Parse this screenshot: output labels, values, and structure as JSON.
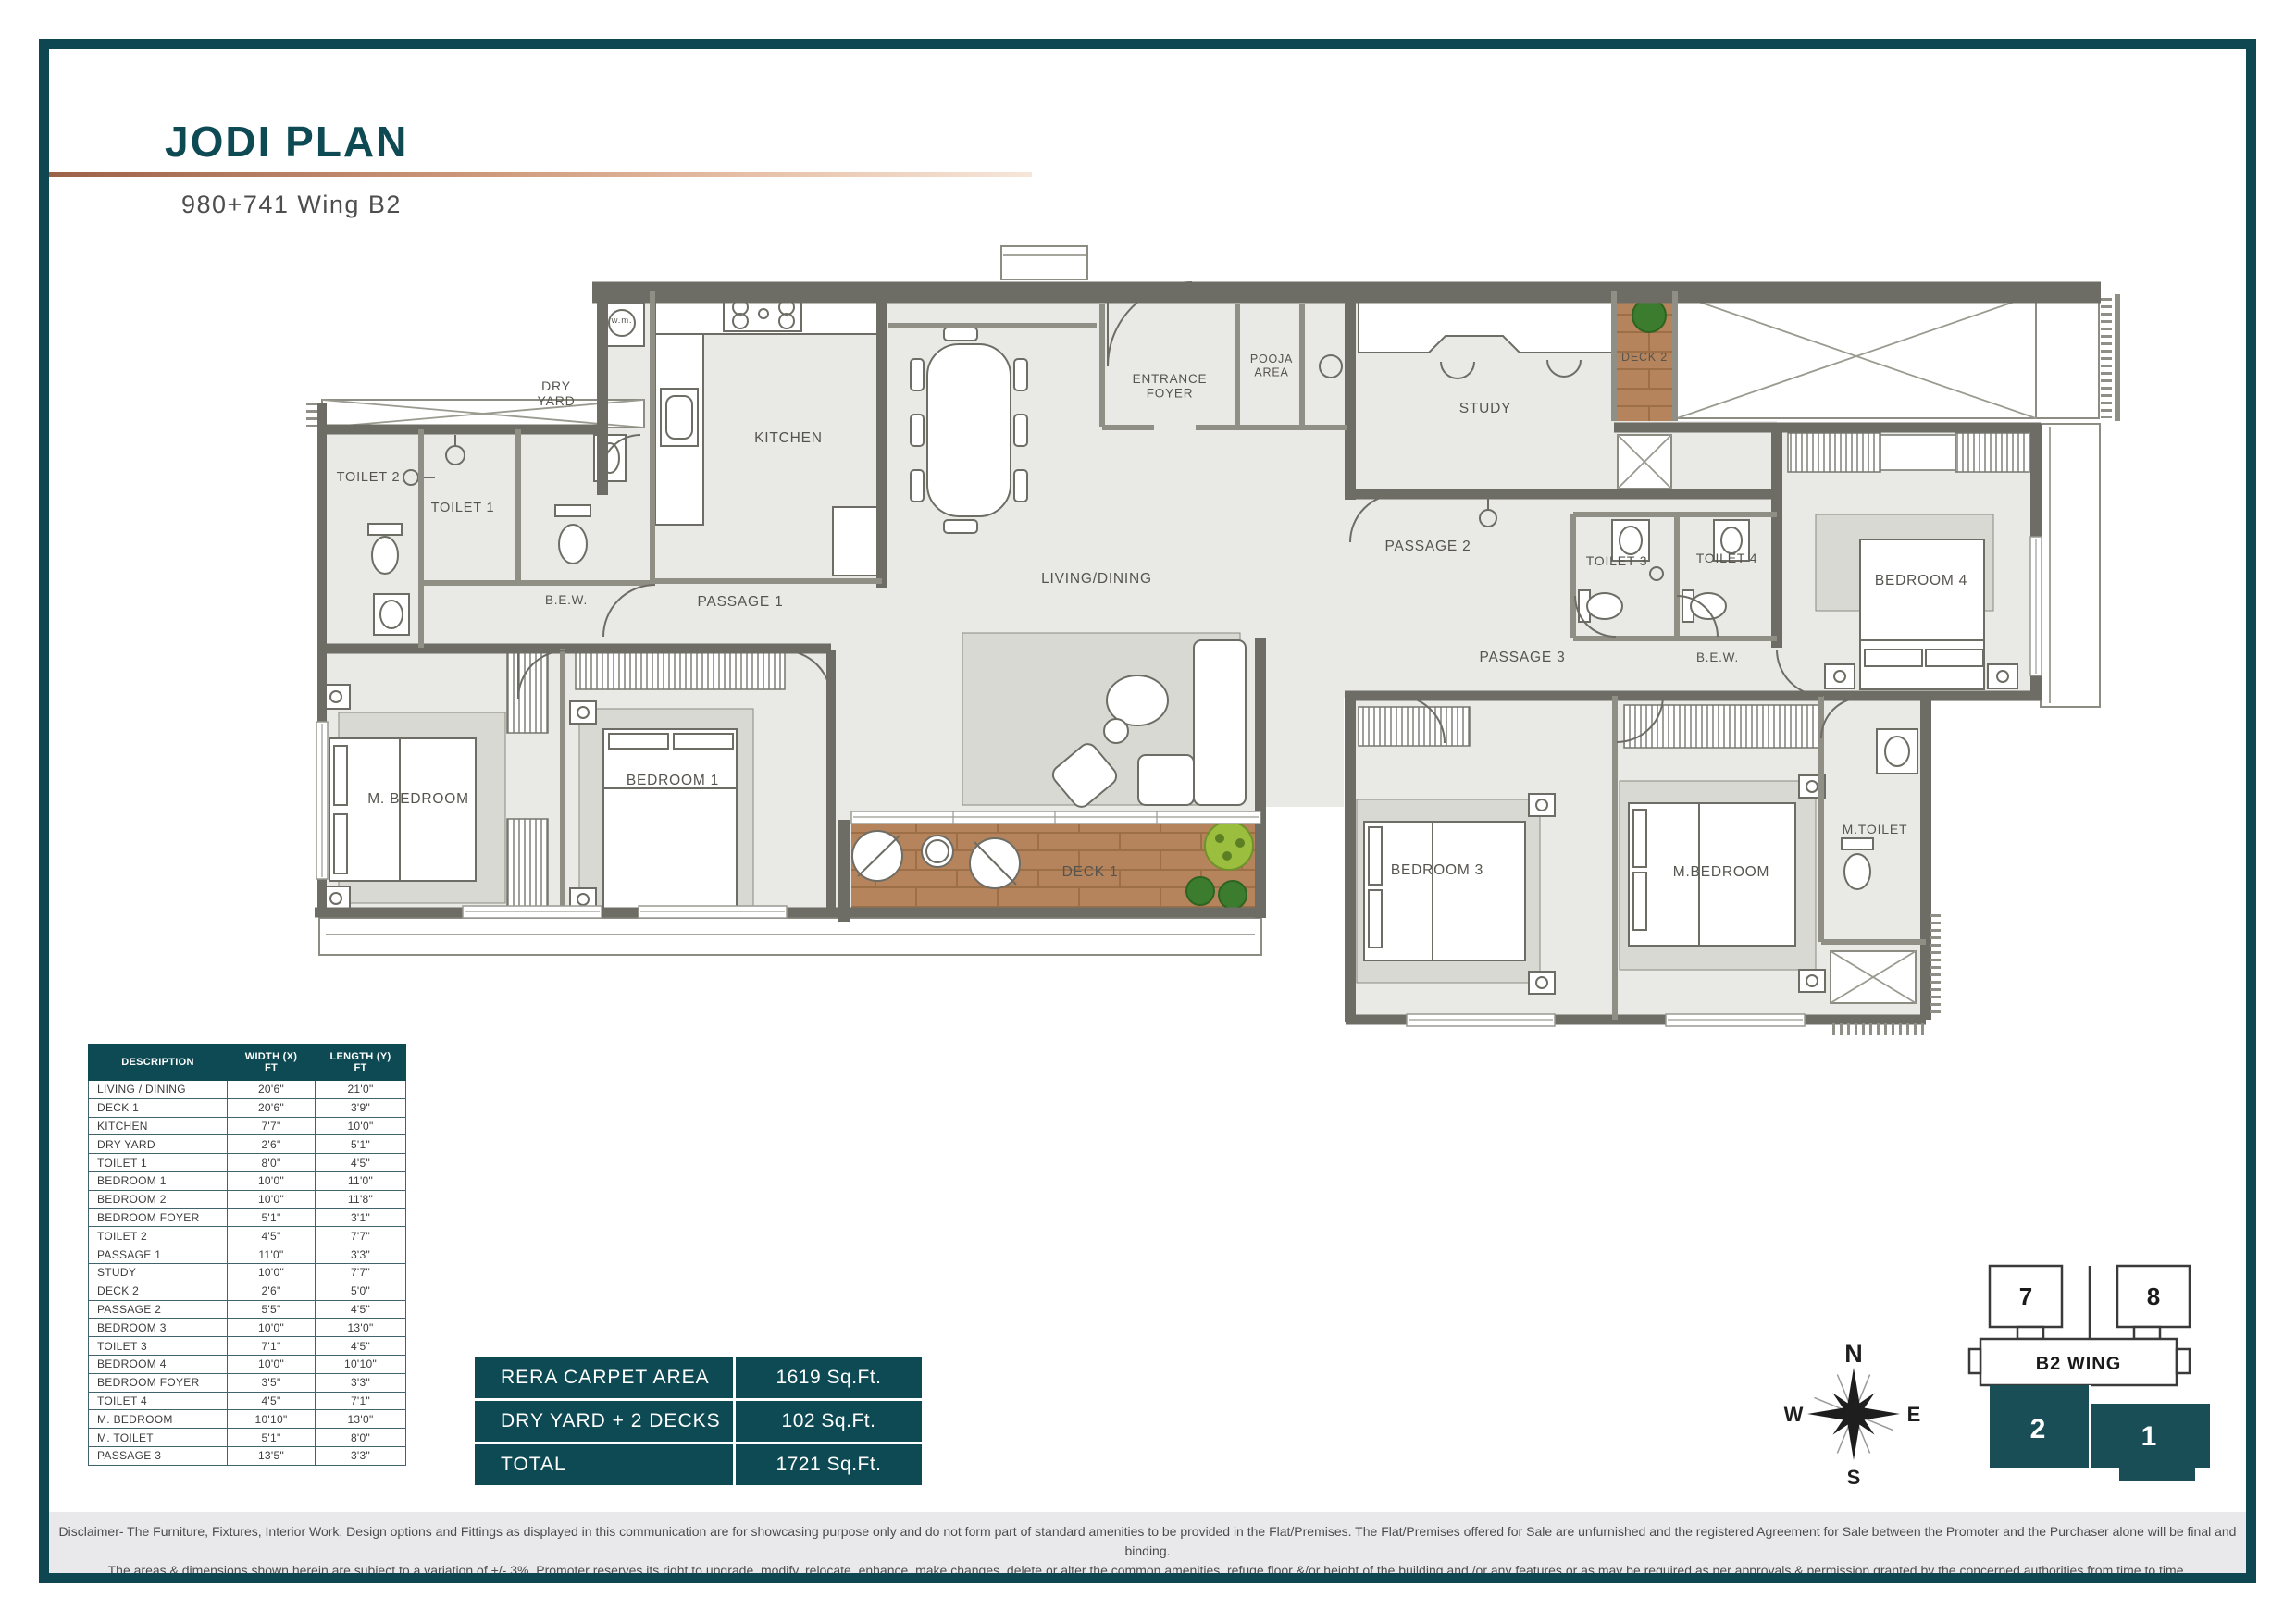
{
  "header": {
    "title": "JODI PLAN",
    "subtitle": "980+741 Wing B2"
  },
  "dimensions_table": {
    "headers": [
      "DESCRIPTION",
      "WIDTH (X)\nFT",
      "LENGTH (Y)\nFT"
    ],
    "rows": [
      [
        "LIVING / DINING",
        "20'6\"",
        "21'0\""
      ],
      [
        "DECK 1",
        "20'6\"",
        "3'9\""
      ],
      [
        "KITCHEN",
        "7'7\"",
        "10'0\""
      ],
      [
        "DRY YARD",
        "2'6\"",
        "5'1\""
      ],
      [
        "TOILET 1",
        "8'0\"",
        "4'5\""
      ],
      [
        "BEDROOM 1",
        "10'0\"",
        "11'0\""
      ],
      [
        "BEDROOM 2",
        "10'0\"",
        "11'8\""
      ],
      [
        "BEDROOM FOYER",
        "5'1\"",
        "3'1\""
      ],
      [
        "TOILET 2",
        "4'5\"",
        "7'7\""
      ],
      [
        "PASSAGE 1",
        "11'0\"",
        "3'3\""
      ],
      [
        "STUDY",
        "10'0\"",
        "7'7\""
      ],
      [
        "DECK 2",
        "2'6\"",
        "5'0\""
      ],
      [
        "PASSAGE 2",
        "5'5\"",
        "4'5\""
      ],
      [
        "BEDROOM 3",
        "10'0\"",
        "13'0\""
      ],
      [
        "TOILET 3",
        "7'1\"",
        "4'5\""
      ],
      [
        "BEDROOM 4",
        "10'0\"",
        "10'10\""
      ],
      [
        "BEDROOM FOYER",
        "3'5\"",
        "3'3\""
      ],
      [
        "TOILET 4",
        "4'5\"",
        "7'1\""
      ],
      [
        "M. BEDROOM",
        "10'10\"",
        "13'0\""
      ],
      [
        "M. TOILET",
        "5'1\"",
        "8'0\""
      ],
      [
        "PASSAGE 3",
        "13'5\"",
        "3'3\""
      ]
    ]
  },
  "area_table": {
    "rows": [
      {
        "label": "RERA CARPET AREA",
        "value": "1619 Sq.Ft."
      },
      {
        "label": "DRY YARD + 2 DECKS",
        "value": "102 Sq.Ft."
      },
      {
        "label": "TOTAL",
        "value": "1721 Sq.Ft."
      }
    ]
  },
  "floorplan": {
    "rooms": [
      {
        "id": "toilet2",
        "label": "TOILET 2"
      },
      {
        "id": "toilet1",
        "label": "TOILET 1"
      },
      {
        "id": "dry_yard",
        "label": "DRY\nYARD"
      },
      {
        "id": "wm",
        "label": "w.m."
      },
      {
        "id": "kitchen",
        "label": "KITCHEN"
      },
      {
        "id": "bew1",
        "label": "B.E.W."
      },
      {
        "id": "passage1",
        "label": "PASSAGE 1"
      },
      {
        "id": "living_dining",
        "label": "LIVING/DINING"
      },
      {
        "id": "entrance_foyer",
        "label": "ENTRANCE\nFOYER"
      },
      {
        "id": "pooja_area",
        "label": "POOJA\nAREA"
      },
      {
        "id": "study",
        "label": "STUDY"
      },
      {
        "id": "passage2",
        "label": "PASSAGE 2"
      },
      {
        "id": "deck2",
        "label": "DECK 2"
      },
      {
        "id": "toilet3",
        "label": "TOILET 3"
      },
      {
        "id": "toilet4",
        "label": "TOILET 4"
      },
      {
        "id": "bedroom4",
        "label": "BEDROOM 4"
      },
      {
        "id": "passage3",
        "label": "PASSAGE 3"
      },
      {
        "id": "bew2",
        "label": "B.E.W."
      },
      {
        "id": "m_bedroom1",
        "label": "M. BEDROOM"
      },
      {
        "id": "bedroom1",
        "label": "BEDROOM 1"
      },
      {
        "id": "deck1",
        "label": "DECK 1"
      },
      {
        "id": "bedroom3",
        "label": "BEDROOM 3"
      },
      {
        "id": "m_bedroom2",
        "label": "M.BEDROOM"
      },
      {
        "id": "m_toilet",
        "label": "M.TOILET"
      }
    ]
  },
  "compass": {
    "north": "N",
    "east": "E",
    "south": "S",
    "west": "W"
  },
  "wing_diagram": {
    "label": "B2 WING",
    "top_units": [
      "7",
      "8"
    ],
    "bottom_units": [
      "2",
      "1"
    ]
  },
  "disclaimer": {
    "line1": "Disclaimer- The Furniture, Fixtures, Interior Work, Design options and Fittings as displayed in this communication are for showcasing purpose only and do not form part of standard amenities to be provided in the Flat/Premises. The Flat/Premises offered for Sale are unfurnished and the registered Agreement for Sale between the Promoter and the Purchaser alone will be final and binding.",
    "line2": "The areas & dimensions shown herein are subject to a variation of +/- 3%. Promoter reserves its right to upgrade, modify, relocate, enhance, make changes, delete or alter the common amenities, refuge floor &/or height of the building and /or any features or as may be required as per approvals & permission granted by the concerned authorities from time to time."
  },
  "colors": {
    "accent_teal": "#0e4a54",
    "frame_teal": "#0e4652",
    "copper": "#cf9a7c",
    "wall_dark": "#6d6d65",
    "wall_light": "#8f8f85",
    "floor": "#e9e9e6",
    "deck_wood": "#b5845c",
    "plant_dark": "#3c7c2e",
    "plant_light": "#9cbe3f",
    "wing_highlight": "#194e57"
  }
}
